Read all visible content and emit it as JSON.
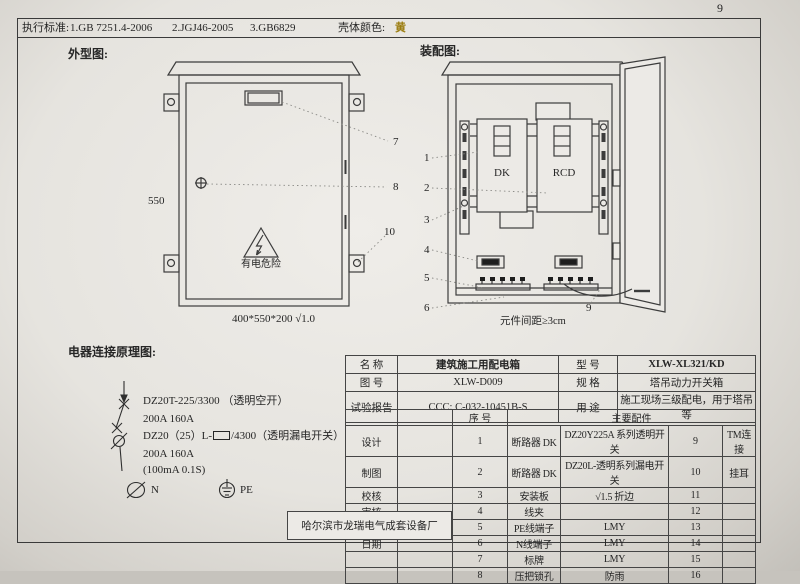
{
  "page": {
    "number": "9"
  },
  "header": {
    "standards_label": "执行标准:",
    "standards": [
      "1.GB 7251.4-2006",
      "2.JGJ46-2005",
      "3.GB6829"
    ],
    "shell_color_label": "壳体颜色:",
    "shell_color_value": "黄",
    "shell_color_hex": "#9b7d10"
  },
  "sections": {
    "outer_view_label": "外型图:",
    "assembly_label": "装配图:",
    "schematic_label": "电器连接原理图:"
  },
  "outer_view": {
    "dim_height": "550",
    "warning_text": "有电危险",
    "caption": "400*550*200  √1.0",
    "callout_7": "7",
    "callout_8": "8",
    "callout_10": "10"
  },
  "assembly": {
    "dk_label": "DK",
    "rcd_label": "RCD",
    "caption": "元件间距≥3cm",
    "callout_1": "1",
    "callout_2": "2",
    "callout_3": "3",
    "callout_4": "4",
    "callout_5": "5",
    "callout_6": "6",
    "callout_9": "9"
  },
  "schematic": {
    "line1": "DZ20T-225/3300 （透明空开）",
    "line2": "200A   160A",
    "line3_pre": "DZ20（25）L-",
    "line3_post": "/4300（透明漏电开关）",
    "line4": "200A   160A",
    "line5": "(100mA 0.1S)",
    "n_label": "N",
    "pe_label": "PE"
  },
  "info": {
    "name_label": "名    称",
    "name_value": "建筑施工用配电箱",
    "model_label": "型    号",
    "model_value": "XLW-XL321/KD",
    "drawing_label": "图    号",
    "drawing_value": "XLW-D009",
    "spec_label": "规    格",
    "spec_value": "塔吊动力开关箱",
    "report_label": "试验报告",
    "report_value": "CCC: C-032-10451B-S",
    "use_label": "用    途",
    "use_value": "施工现场三级配电，用于塔吊等",
    "seq_header": "序  号",
    "parts_header": "主要配件",
    "credits": [
      "设计",
      "制图",
      "校核",
      "审核",
      "标准化",
      "日期"
    ],
    "manufacturer": "哈尔滨市龙瑞电气成套设备厂",
    "parts": [
      {
        "no": "1",
        "name": "断路器 DK",
        "spec": "DZ20Y225A 系列透明开关",
        "no2": "9",
        "name2": "TM连接"
      },
      {
        "no": "2",
        "name": "断路器 DK",
        "spec": "DZ20L-透明系列漏电开关",
        "no2": "10",
        "name2": "挂耳"
      },
      {
        "no": "3",
        "name": "安装板",
        "spec": "√1.5 折边",
        "no2": "11",
        "name2": ""
      },
      {
        "no": "4",
        "name": "线夹",
        "spec": "",
        "no2": "12",
        "name2": ""
      },
      {
        "no": "5",
        "name": "PE线端子",
        "spec": "LMY",
        "no2": "13",
        "name2": ""
      },
      {
        "no": "6",
        "name": "N线端子",
        "spec": "LMY",
        "no2": "14",
        "name2": ""
      },
      {
        "no": "7",
        "name": "标牌",
        "spec": "LMY",
        "no2": "15",
        "name2": ""
      },
      {
        "no": "8",
        "name": "压把锁孔",
        "spec": "防雨",
        "no2": "16",
        "name2": ""
      }
    ]
  }
}
